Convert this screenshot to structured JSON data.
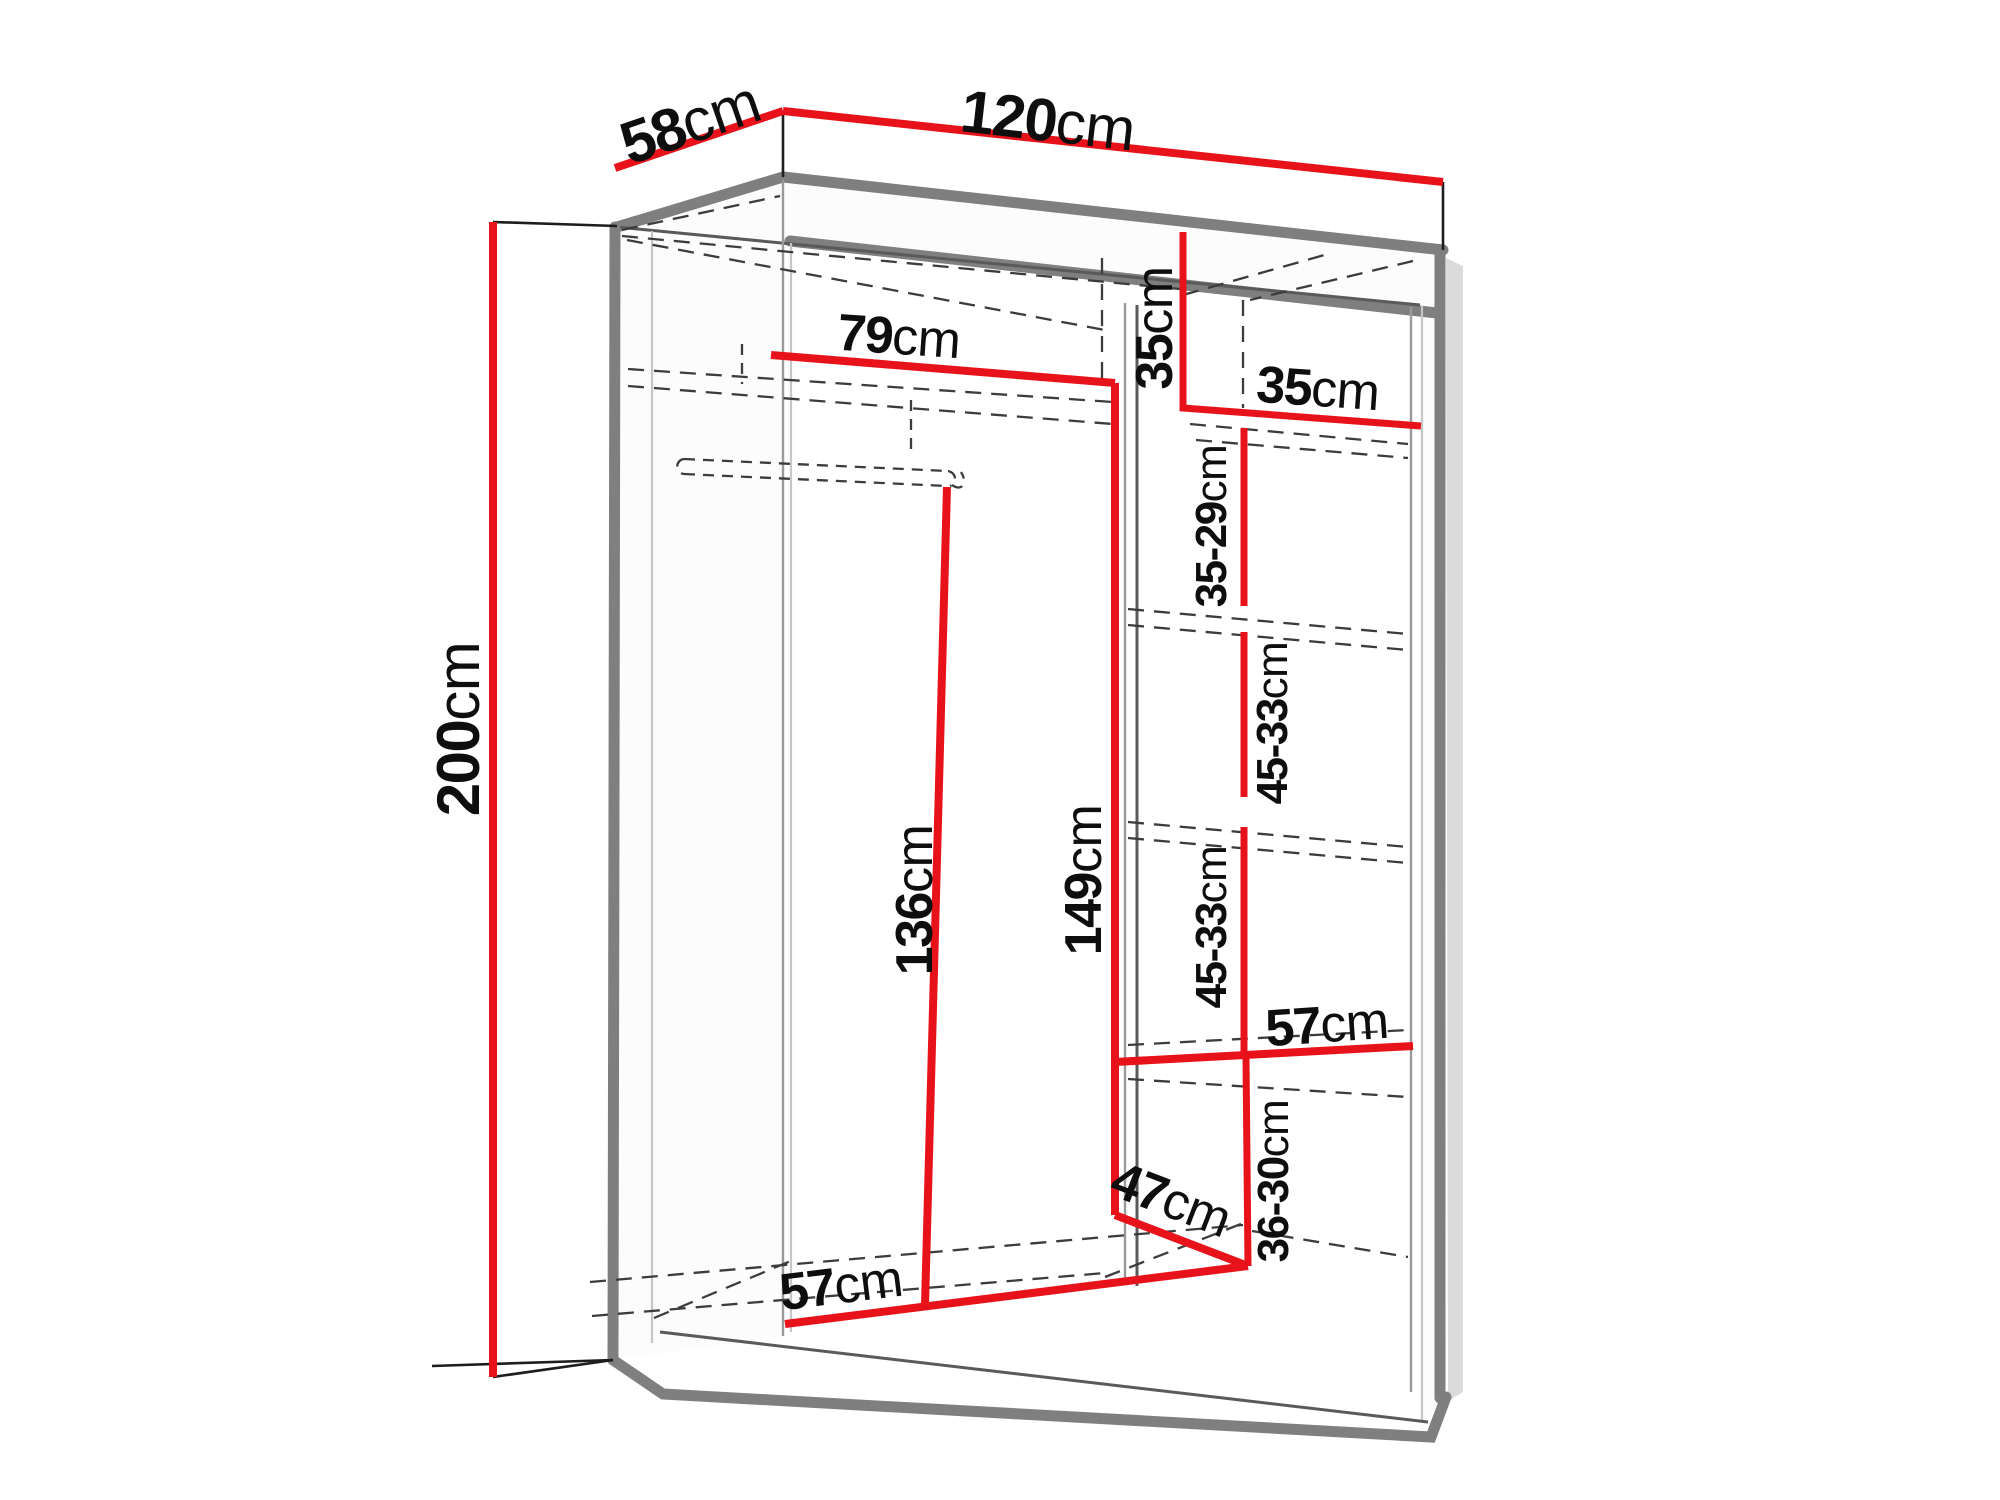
{
  "diagram": {
    "name": "wardrobe-dimensions-diagram",
    "unit": "cm",
    "colors": {
      "dimension_line": "#e8131a",
      "structure": "#7f7f7f",
      "dashed": "#3c3c3c",
      "text": "#0e0e0e",
      "background": "#ffffff"
    }
  },
  "dimensions": {
    "depth_top": {
      "value": "58",
      "unit": "cm"
    },
    "width_top": {
      "value": "120",
      "unit": "cm"
    },
    "height_left": {
      "value": "200",
      "unit": "cm"
    },
    "left_shelf_width": {
      "value": "79",
      "unit": "cm"
    },
    "right_top_height": {
      "value": "35",
      "unit": "cm"
    },
    "right_top_width": {
      "value": "35",
      "unit": "cm"
    },
    "right_gap_1": {
      "value": "35-29",
      "unit": "cm"
    },
    "right_gap_2": {
      "value": "45-33",
      "unit": "cm"
    },
    "left_hanging_height": {
      "value": "136",
      "unit": "cm"
    },
    "right_column_height": {
      "value": "149",
      "unit": "cm"
    },
    "right_gap_3": {
      "value": "45-33",
      "unit": "cm"
    },
    "right_shelf_width": {
      "value": "57",
      "unit": "cm"
    },
    "right_bottom_height": {
      "value": "36-30",
      "unit": "cm"
    },
    "bottom_depth": {
      "value": "47",
      "unit": "cm"
    },
    "left_bottom_width": {
      "value": "57",
      "unit": "cm"
    }
  }
}
